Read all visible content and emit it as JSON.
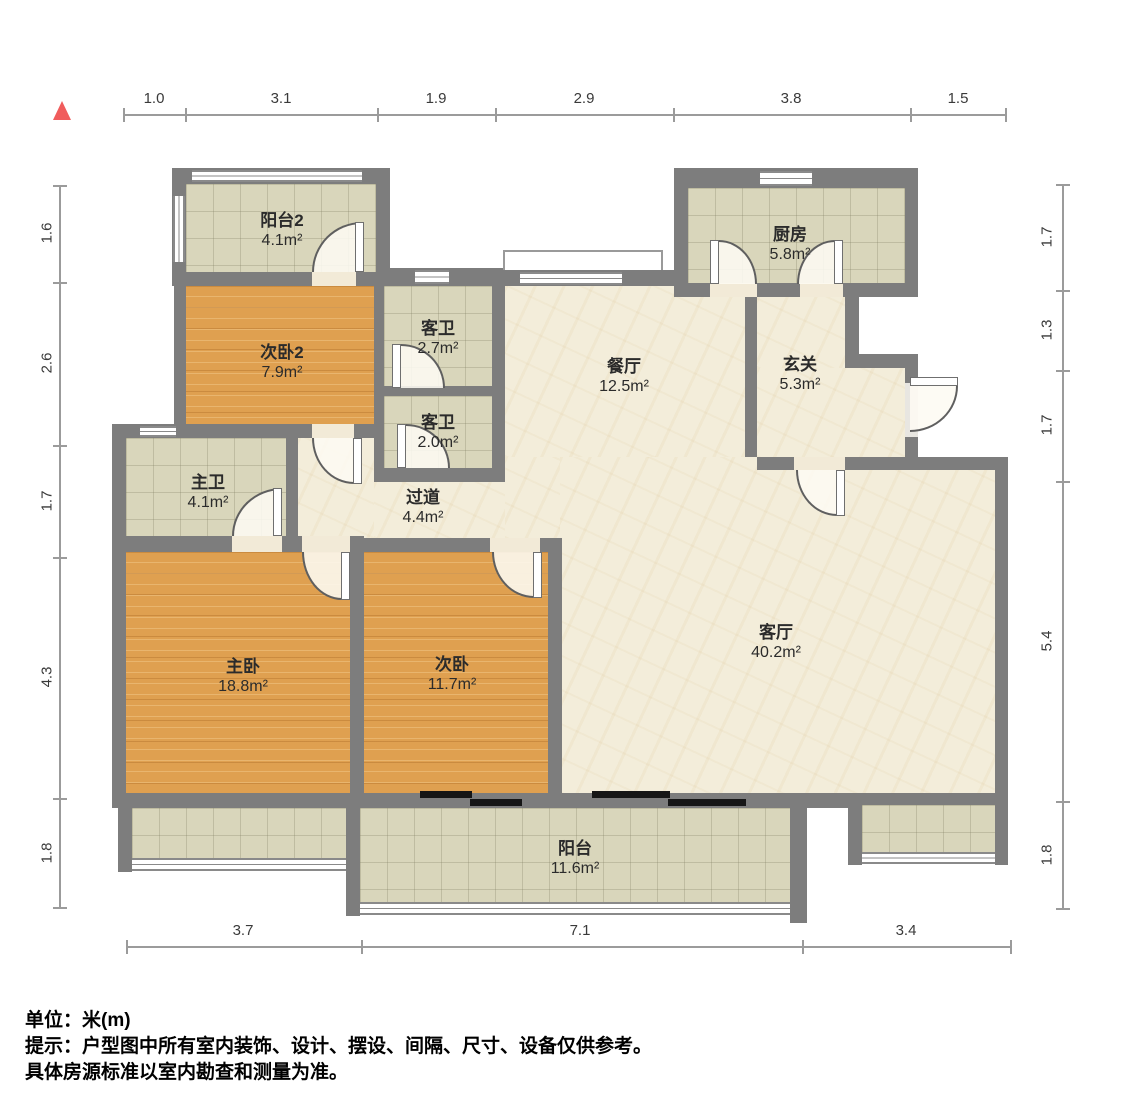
{
  "north_marker": {
    "icon": "north-triangle",
    "color": "#f05c5c"
  },
  "dimensions": {
    "top": [
      "1.0",
      "3.1",
      "1.9",
      "2.9",
      "3.8",
      "1.5"
    ],
    "left": [
      "1.6",
      "2.6",
      "1.7",
      "4.3",
      "1.8"
    ],
    "right": [
      "1.7",
      "1.3",
      "1.7",
      "5.4",
      "1.8"
    ],
    "bottom": [
      "3.7",
      "7.1",
      "3.4"
    ]
  },
  "rooms": {
    "balcony2": {
      "name": "阳台2",
      "area": "4.1m²"
    },
    "bedroom2": {
      "name": "次卧2",
      "area": "7.9m²"
    },
    "guest_bath_upper": {
      "name": "客卫",
      "area": "2.7m²"
    },
    "guest_bath_lower": {
      "name": "客卫",
      "area": "2.0m²"
    },
    "dining": {
      "name": "餐厅",
      "area": "12.5m²"
    },
    "kitchen": {
      "name": "厨房",
      "area": "5.8m²"
    },
    "entry": {
      "name": "玄关",
      "area": "5.3m²"
    },
    "master_bath": {
      "name": "主卫",
      "area": "4.1m²"
    },
    "hallway": {
      "name": "过道",
      "area": "4.4m²"
    },
    "master_bedroom": {
      "name": "主卧",
      "area": "18.8m²"
    },
    "bedroom": {
      "name": "次卧",
      "area": "11.7m²"
    },
    "living": {
      "name": "客厅",
      "area": "40.2m²"
    },
    "balcony": {
      "name": "阳台",
      "area": "11.6m²"
    }
  },
  "footnotes": {
    "unit": "单位：米(m)",
    "hint": "提示：户型图中所有室内装饰、设计、摆设、间隔、尺寸、设备仅供参考。",
    "hint2": "具体房源标准以室内勘查和测量为准。"
  },
  "colors": {
    "wall": "#7d7d7d",
    "wood_floor": "#dfa050",
    "tile_floor": "#d9d6bb",
    "marble_floor": "#f3edda",
    "north": "#f05c5c"
  }
}
